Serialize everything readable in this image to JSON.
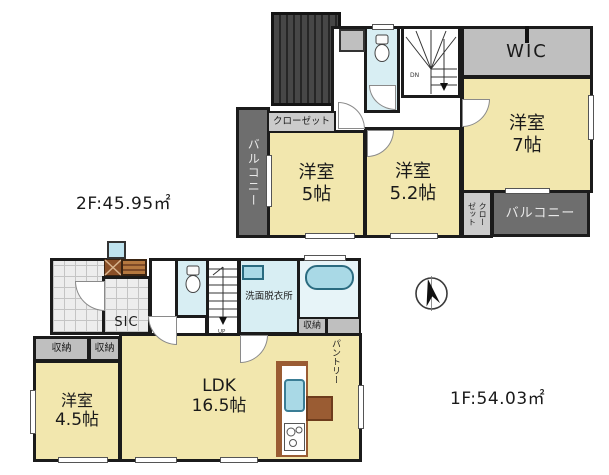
{
  "colors": {
    "room_yellow": "#f2e7ae",
    "water_blue": "#d8eef3",
    "tub_blue": "#a9d9e6",
    "storage_gray": "#bfbfbf",
    "closet_gray": "#cbcbcb",
    "balcony_gray": "#6e6e6e",
    "wall_black": "#1b1b1b",
    "wood_brown": "#9a5c33",
    "tile_gray": "#ededed"
  },
  "floor2": {
    "area_label": "2F:45.95㎡",
    "wic": "WIC",
    "closet_top": "クローゼット",
    "closet_side": {
      "right_col": "クロー",
      "left_col": "ゼット"
    },
    "balcony_left": "バルコニー",
    "balcony_right": "バルコニー",
    "stairs": "DN",
    "bed5": {
      "name": "洋室",
      "size": "5帖"
    },
    "bed52": {
      "name": "洋室",
      "size": "5.2帖"
    },
    "bed7": {
      "name": "洋室",
      "size": "7帖"
    }
  },
  "floor1": {
    "area_label": "1F:54.03㎡",
    "sic": "SIC",
    "storage_left_a": "収納",
    "storage_left_b": "収納",
    "storage_right": "収納",
    "pantry": "パントリー",
    "washroom": "洗面脱衣所",
    "stairs": "UP",
    "bed45": {
      "name": "洋室",
      "size": "4.5帖"
    },
    "ldk": {
      "name": "LDK",
      "size": "16.5帖"
    }
  }
}
